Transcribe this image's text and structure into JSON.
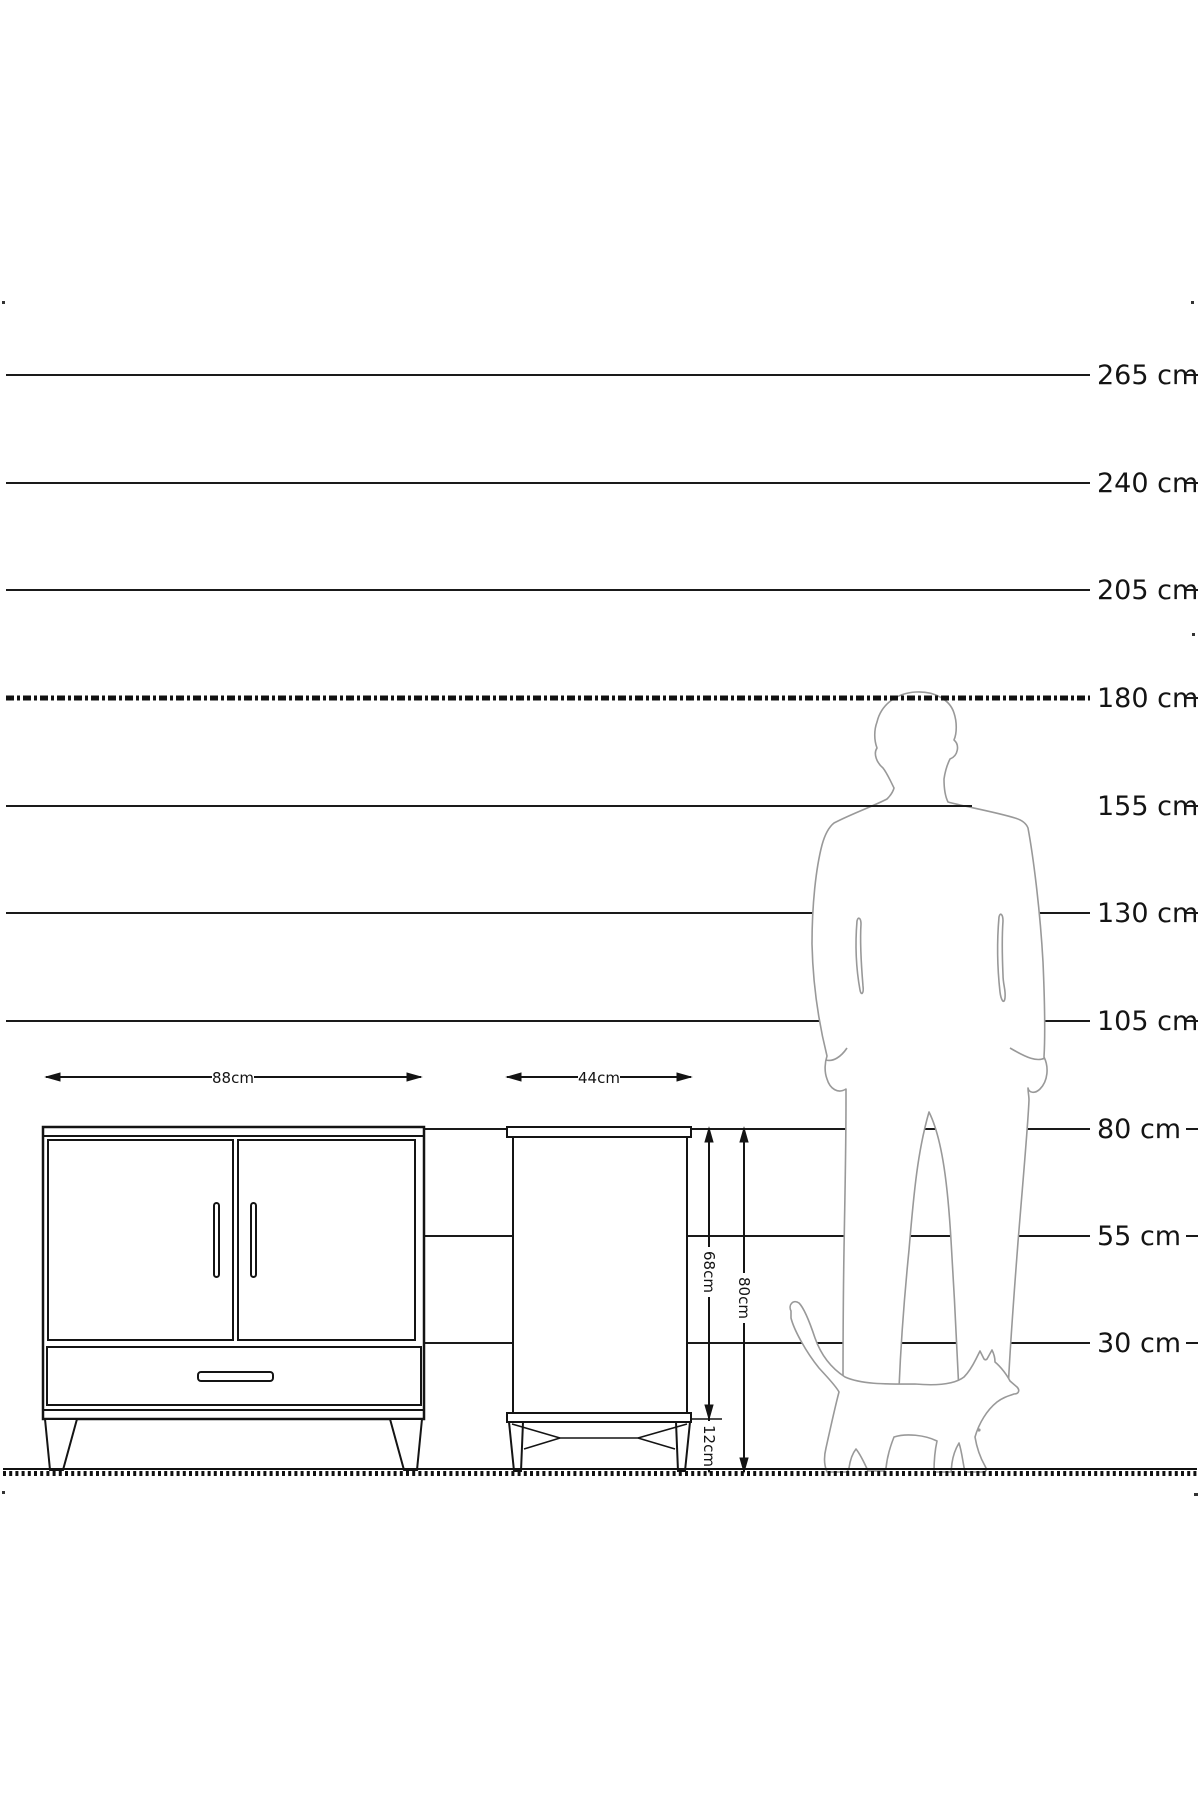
{
  "diagram": {
    "type": "furniture dimension scale drawing",
    "unit": "cm"
  },
  "scale": {
    "entries": [
      {
        "label": "265 cm",
        "value": 265
      },
      {
        "label": "240 cm",
        "value": 240
      },
      {
        "label": "205 cm",
        "value": 205
      },
      {
        "label": "180 cm",
        "value": 180
      },
      {
        "label": "155 cm",
        "value": 155
      },
      {
        "label": "130 cm",
        "value": 130
      },
      {
        "label": "105 cm",
        "value": 105
      },
      {
        "label": "80 cm",
        "value": 80
      },
      {
        "label": "55 cm",
        "value": 55
      },
      {
        "label": "30 cm",
        "value": 30
      }
    ]
  },
  "dimensions": {
    "front_width": "88cm",
    "side_depth": "44cm",
    "body_height": "68cm",
    "total_height": "80cm",
    "leg_height": "12cm"
  },
  "figures": {
    "man": "standing man silhouette (reference height 180 cm)",
    "cat": "walking cat silhouette"
  },
  "colors": {
    "line": "#1a1a1a",
    "figure_outline": "#999999",
    "background": "#ffffff"
  }
}
